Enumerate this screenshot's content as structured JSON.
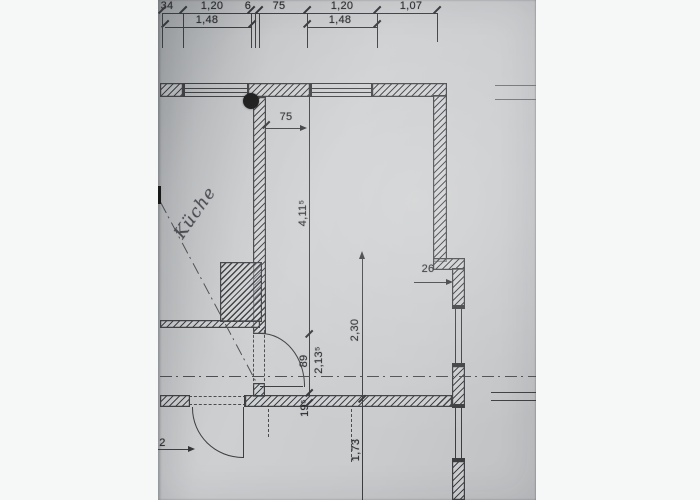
{
  "plan": {
    "room_name": "Küche",
    "dims": {
      "top_chain": [
        "34",
        "1,20",
        "6",
        "75",
        "1,20",
        "1,07"
      ],
      "window_chain": [
        "1,48",
        "1,48"
      ],
      "v75": "75",
      "v4115": "4,11⁵",
      "v89": "89",
      "v2135": "2,13⁵",
      "v195": "19⁵",
      "v26": "26",
      "v230": "2,30",
      "v173": "1,73",
      "v2": "2"
    },
    "colors": {
      "paper": "#c7c9cb",
      "margin": "#f6f7f7",
      "ink": "#3b3d3f",
      "pencil": "#45474d"
    }
  }
}
